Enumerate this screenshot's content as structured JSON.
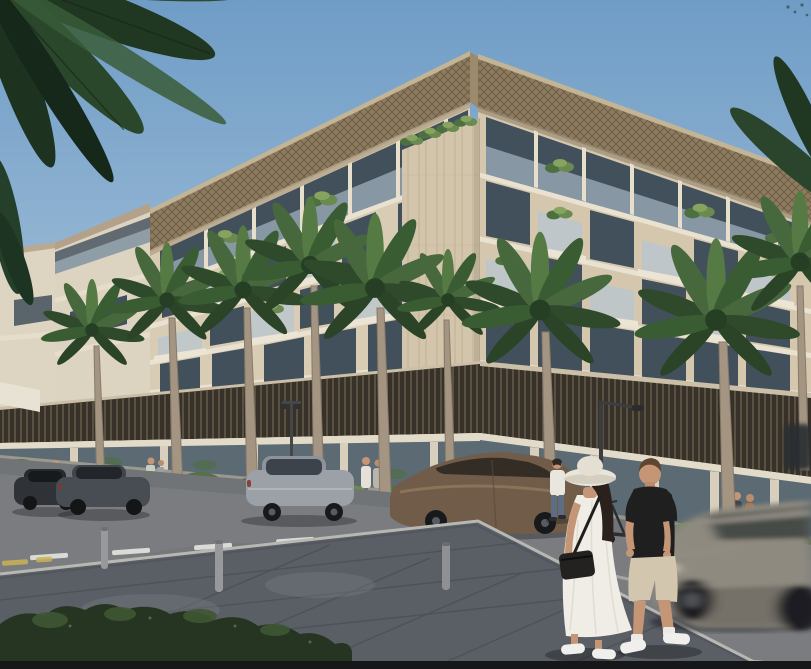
{
  "meta": {
    "description": "Sunny 3D architectural rendering of a modern cream-stone apartment building on a street corner, with glass balconies full of plants, a dark bronze louvre podium, glass storefronts, royal palms, parked sedans, a motion-blurred passing car, and a couple walking in the foreground.",
    "image_type": "architectural exterior render"
  },
  "palette": {
    "sky_top": "#6f9cc6",
    "sky_mid": "#9dbcd6",
    "sky_horizon": "#cfdfe9",
    "facade_left": "#d9ccb4",
    "facade_right": "#d5c7ae",
    "facade_wing": "#ddd3c1",
    "roof_lattice": "#8d7b60",
    "travertine": "#d3c5ab",
    "podium_louvres": "#37312a",
    "window_glass": "#42505c",
    "railing_glass": "#b6c6d2",
    "storefront_glass": "#5b6a73",
    "palm_green": "#3f6036",
    "hedge_green": "#55713f",
    "shrub_dark": "#263522",
    "road": "#7a7c7f",
    "plaza": "#5a5e65",
    "curb": "#b7b8b2",
    "lane_white": "#dadbd6",
    "lane_yellow": "#c9b455",
    "car_dark": "#2f3338",
    "car_gray": "#484d53",
    "car_silver": "#9ba1a7",
    "car_bronze": "#705c48",
    "car_blur": "#8f8a80",
    "dress_white": "#f0ede6",
    "shirt_black": "#201f1f",
    "shorts_khaki": "#d2c6ae",
    "skin": "#c49676",
    "trunk": "#a39582",
    "bottom_strip": "#161719"
  },
  "scene": {
    "sky": "clear blue sky with a few distant birds top right",
    "building": "6-storey cream stone apartment block seen at a corner; lattice roof overhang, plant-filled glass balconies, travertine corner pier, dark bronze vertical-louvre podium band, glass retail ground floor",
    "vegetation": "overhanging dark palm fronds top left, royal palms along both streets, hedge planters at the base, dark shrub bottom left",
    "street": "asphalt road with dashed white lane markings and yellow edge dashes, paved corner plaza with bollards",
    "vehicles": "four parked sedans on the left street, one motion-blurred car passing on the right, a standing e-scooter",
    "people": "woman in white sun hat and white dress with black crossbody bag and man in black t-shirt and beige shorts walking in the foreground; man in white shirt and jeans crossing; small groups near the storefronts"
  }
}
